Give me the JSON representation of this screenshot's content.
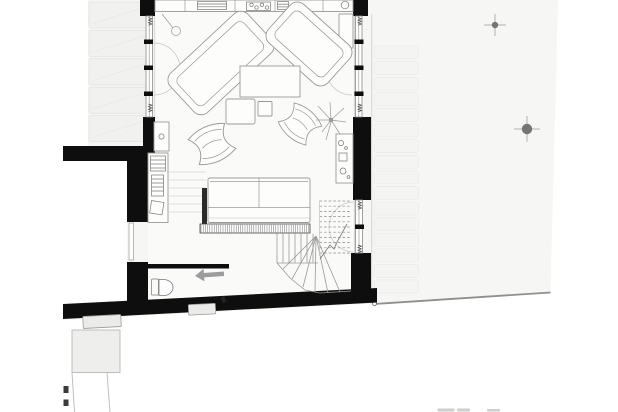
{
  "drawing": {
    "kind": "architectural-floor-plan",
    "aria_label": "Black and white architectural ground-floor plan: living room with two angled sofas, coffee tables, butterfly chairs, large sofa, kitchen counter, kitchenette, desk, bathroom with toilet and entry arrow, winder staircase with dashed upper flight, paved strip on the west, terrace slabs and garden with two surveyed tree markers on the east, slanted boundary wall at the south"
  },
  "colors": {
    "bg": "#ffffff",
    "site": "#f6f6f4",
    "room": "#fafaf9",
    "wall": "#0e0e0e",
    "stroke-mid": "#8a8a8a",
    "stroke-light": "#c4c4c2",
    "paving-fill": "#f1f1ef",
    "paving-stroke": "#e3e3e1",
    "terr-fill": "#f4f4f2",
    "terr-stroke": "#eaeae8",
    "furn-fill": "#fdfdfc",
    "furn-stroke": "#9a9a98",
    "hatch": "#606060",
    "marker": "#757573",
    "marker-cross": "#b3b3b1",
    "boundary": "#8f8f8d",
    "arrow": "#9c9c9c",
    "annex-fill": "#eeeeec",
    "annex-stroke": "#b9b9b7",
    "step-fill": "#ebebe9"
  },
  "site": {
    "tree_markers": [
      {
        "x": 495,
        "y": 25,
        "r": 3.2,
        "arm": 11
      },
      {
        "x": 527,
        "y": 129,
        "r": 5.2,
        "arm": 13
      }
    ],
    "boundary_line": {
      "x1": 374,
      "y1": 304,
      "x2": 550.5,
      "y2": 292.5
    }
  },
  "counts": {
    "west_paving_bands": 5,
    "east_terrace_slabs": 16,
    "straight_stair_treads": 6,
    "winder_treads": 6,
    "upper_flight_dashed_lines": 11,
    "parapet_hatch_span": [
      201,
      309
    ]
  }
}
